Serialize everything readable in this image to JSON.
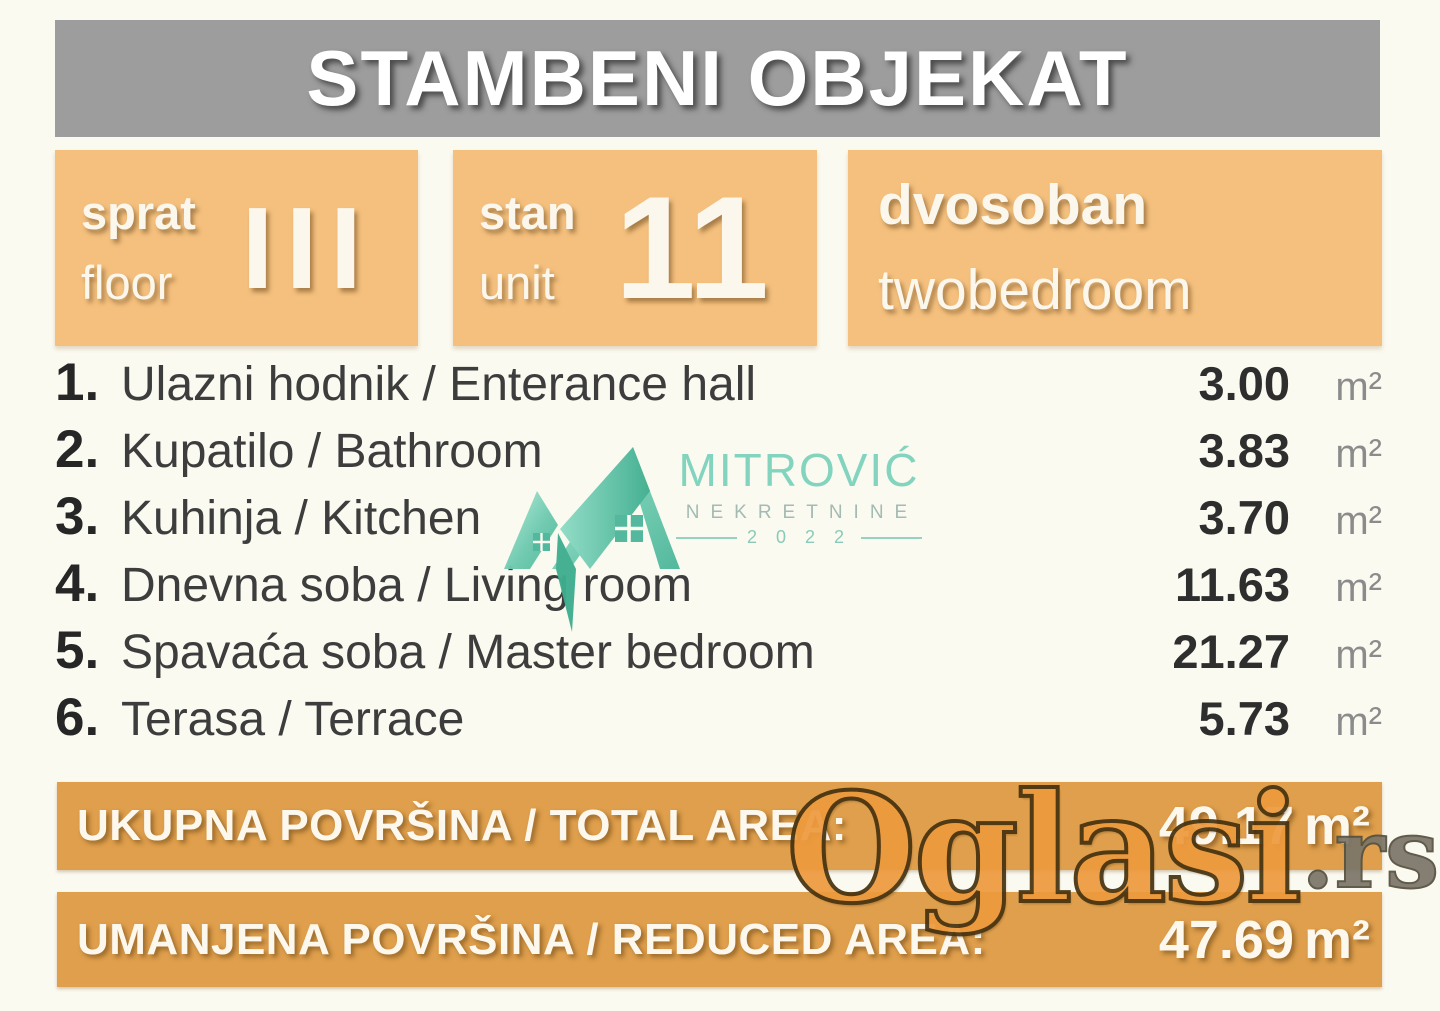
{
  "header": {
    "title": "STAMBENI OBJEKAT"
  },
  "info_boxes": {
    "floor": {
      "label_sr": "sprat",
      "label_en": "floor",
      "value": "III"
    },
    "unit": {
      "label_sr": "stan",
      "label_en": "unit",
      "value": "11"
    },
    "layout": {
      "label_sr": "dvosoban",
      "label_en": "twobedroom"
    }
  },
  "rooms": [
    {
      "num": "1.",
      "name": "Ulazni hodnik / Enterance hall",
      "area": "3.00",
      "unit": "m²"
    },
    {
      "num": "2.",
      "name": "Kupatilo / Bathroom",
      "area": "3.83",
      "unit": "m²"
    },
    {
      "num": "3.",
      "name": "Kuhinja / Kitchen",
      "area": "3.70",
      "unit": "m²"
    },
    {
      "num": "4.",
      "name": "Dnevna soba / Living room",
      "area": "11.63",
      "unit": "m²"
    },
    {
      "num": "5.",
      "name": "Spavaća soba / Master bedroom",
      "area": "21.27",
      "unit": "m²"
    },
    {
      "num": "6.",
      "name": "Terasa / Terrace",
      "area": "5.73",
      "unit": "m²"
    }
  ],
  "totals": [
    {
      "label": "UKUPNA POVRŠINA / TOTAL AREA:",
      "value": "49.17",
      "unit": "m²"
    },
    {
      "label": "UMANJENA POVRŠINA / REDUCED AREA:",
      "value": "47.69",
      "unit": "m²"
    }
  ],
  "watermarks": {
    "agency": {
      "name": "MITROVIĆ",
      "line2": "NEKRETNINE",
      "year": "2 0 2 2"
    },
    "portal": {
      "name": "Oglasi",
      "suffix": ".rs"
    }
  },
  "colors": {
    "banner_gray": "#9d9d9d",
    "box_orange": "#f5c07e",
    "bar_orange": "#df9f4c",
    "agency_teal": "#62c6aa",
    "portal_orange": "#ee9a3e"
  }
}
